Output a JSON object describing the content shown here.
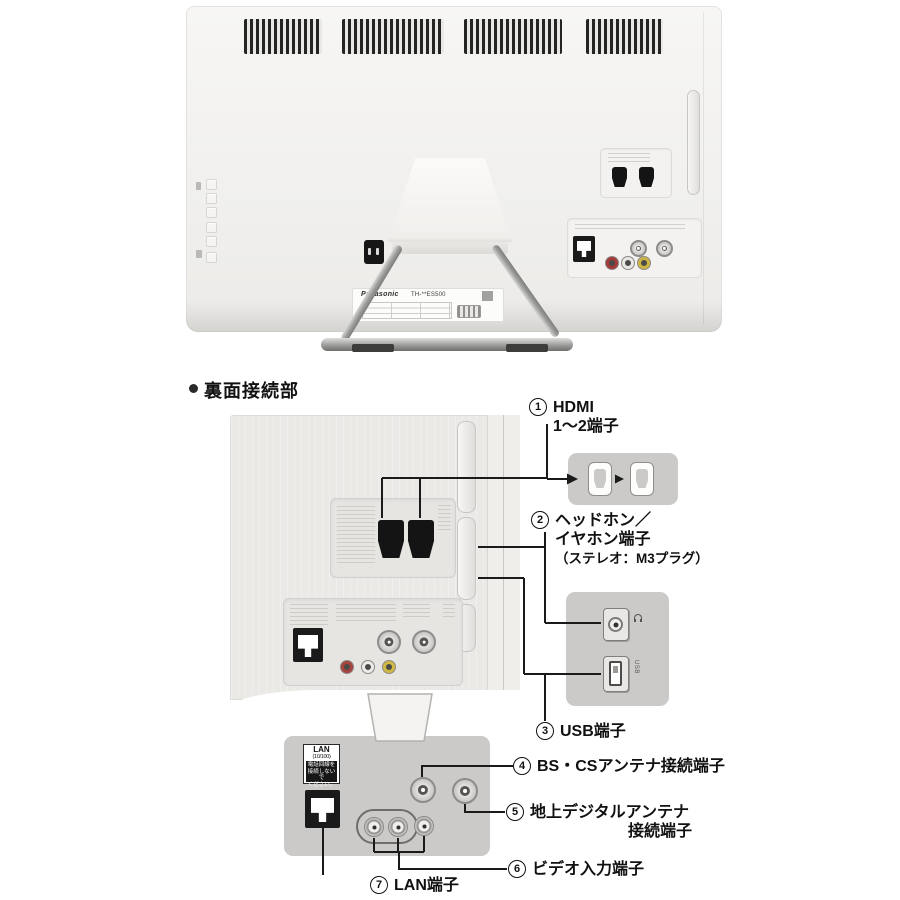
{
  "photo": {
    "brand": "Panasonic",
    "model": "TH-**ES500"
  },
  "heading": {
    "text": "裏面接続部"
  },
  "callouts": {
    "c1": {
      "num": "1",
      "line1": "HDMI",
      "line2": "1〜2端子"
    },
    "c2": {
      "num": "2",
      "line1": "ヘッドホン／",
      "line2": "イヤホン端子",
      "line3": "（ステレオ：M3プラグ）"
    },
    "c3": {
      "num": "3",
      "text": "USB端子"
    },
    "c4": {
      "num": "4",
      "text": "BS・CSアンテナ接続端子"
    },
    "c5": {
      "num": "5",
      "line1": "地上デジタルアンテナ",
      "line2": "接続端子"
    },
    "c6": {
      "num": "6",
      "text": "ビデオ入力端子"
    },
    "c7": {
      "num": "7",
      "text": "LAN端子"
    }
  },
  "lan_block": {
    "title": "LAN",
    "subtitle": "(10/100)",
    "warn1": "電話回線を",
    "warn2": "接続しないで",
    "warn3": "ください。"
  },
  "side_inset": {
    "usb_label": "USB"
  },
  "colors": {
    "line": "#1a1a1a",
    "inset_bg": "#cbcac8",
    "panel_bg": "#eae9e6"
  }
}
